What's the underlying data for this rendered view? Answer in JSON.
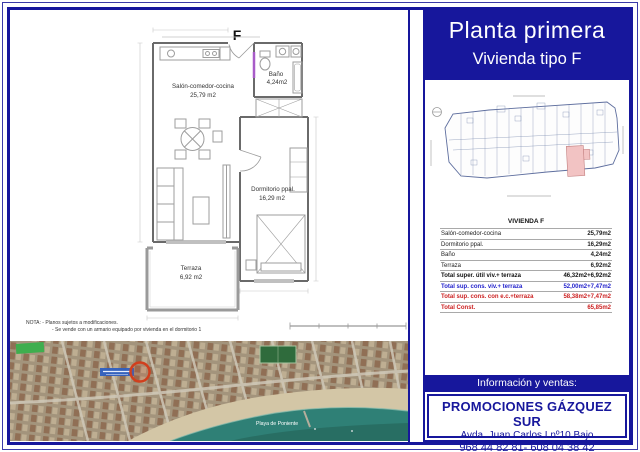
{
  "titles": {
    "main": "Planta primera",
    "sub": "Vivienda tipo F"
  },
  "plan": {
    "type_letter": "F",
    "rooms": {
      "salon": {
        "name": "Salón-comedor-cocina",
        "area": "25,79 m2"
      },
      "bano": {
        "name": "Baño",
        "area": "4,24m2"
      },
      "dormitorio": {
        "name": "Dormitorio ppal.",
        "area": "16,29 m2"
      },
      "terraza": {
        "name": "Terraza",
        "area": "6,92 m2"
      }
    },
    "notes": {
      "line1": "NOTA: - Planos sujetos a modificaciones.",
      "line2": "- Se vende con un armario equipado por vivienda en el dormitorio 1"
    }
  },
  "table": {
    "header": "VIVIENDA F",
    "rows": [
      {
        "label": "Salón-comedor-cocina",
        "value": "25,79m2"
      },
      {
        "label": "Dormitorio ppal.",
        "value": "16,29m2"
      },
      {
        "label": "Baño",
        "value": "4,24m2"
      },
      {
        "label": "Terraza",
        "value": "6,92m2"
      },
      {
        "label": "Total super. útil viv.+ terraza",
        "value": "46,32m2+6,92m2"
      },
      {
        "label": "Total sup. cons. viv.+ terraza",
        "value": "52,00m2+7,47m2"
      },
      {
        "label": "Total sup. cons. con e.c.+terraza",
        "value": "58,38m2+7,47m2"
      },
      {
        "label": "Total Const.",
        "value": "65,85m2"
      }
    ]
  },
  "sales": {
    "info_bar": "Información y ventas:",
    "company": "PROMOCIONES GÁZQUEZ SUR",
    "address": "Avda. Juan Carlos I nº10 Bajo",
    "phones": "968 44 82 81- 608 04 38 42"
  },
  "map": {
    "beach_label": "Playa de Poniente"
  },
  "colors": {
    "navy": "#17179c",
    "table_blue": "#2323cc",
    "table_red": "#cc2222",
    "keyplan_highlight": "#f2c3c3",
    "marker_red": "#d13f1d",
    "sea": "#2f8076",
    "door_highlight": "#a85cc8"
  }
}
